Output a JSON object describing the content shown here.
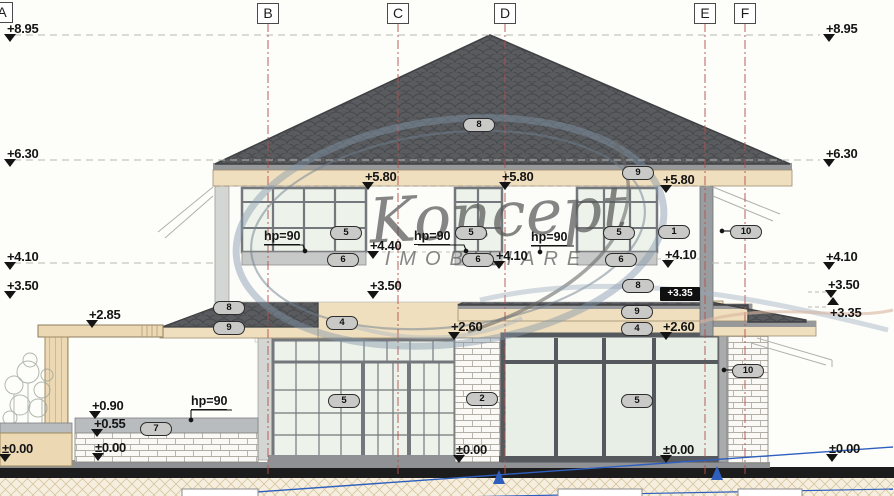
{
  "watermark": {
    "name": "Koncept",
    "subtitle": "IMOBILIARE"
  },
  "grid": {
    "letters": [
      "A",
      "B",
      "C",
      "D",
      "E",
      "F"
    ]
  },
  "hp": {
    "text": "hp=90"
  },
  "marks": [
    {
      "text": "+8.95"
    },
    {
      "text": "+6.30"
    },
    {
      "text": "+4.10"
    },
    {
      "text": "+3.50"
    },
    {
      "text": "±0.00"
    },
    {
      "text": "+8.95"
    },
    {
      "text": "+6.30"
    },
    {
      "text": "+4.10"
    },
    {
      "text": "+3.50"
    },
    {
      "text": "+3.35"
    },
    {
      "text": "±0.00"
    },
    {
      "text": "+5.80"
    },
    {
      "text": "+5.80"
    },
    {
      "text": "+5.80"
    },
    {
      "text": "+4.40"
    },
    {
      "text": "+4.10"
    },
    {
      "text": "+4.10"
    },
    {
      "text": "+3.50"
    },
    {
      "text": "+2.85"
    },
    {
      "text": "+2.60"
    },
    {
      "text": "+2.60"
    },
    {
      "text": "+0.90"
    },
    {
      "text": "+0.55"
    },
    {
      "text": "±0.00"
    },
    {
      "text": "±0.00"
    },
    {
      "text": "±0.00"
    },
    {
      "text": "+3.35"
    }
  ],
  "numbers": [
    {
      "text": "8"
    },
    {
      "text": "9"
    },
    {
      "text": "5"
    },
    {
      "text": "6"
    },
    {
      "text": "5"
    },
    {
      "text": "6"
    },
    {
      "text": "5"
    },
    {
      "text": "6"
    },
    {
      "text": "1"
    },
    {
      "text": "10"
    },
    {
      "text": "8"
    },
    {
      "text": "9"
    },
    {
      "text": "4"
    },
    {
      "text": "8"
    },
    {
      "text": "9"
    },
    {
      "text": "4"
    },
    {
      "text": "2"
    },
    {
      "text": "5"
    },
    {
      "text": "5"
    },
    {
      "text": "10"
    },
    {
      "text": "7"
    }
  ],
  "colors": {
    "roof": "#595b5f",
    "roof_edge": "#3f4144",
    "fascia": "#f0dfbe",
    "trim_gray": "#96989a",
    "pane": "#edf2ea",
    "frame": "#74787c",
    "frame_dark": "#55585c",
    "band_beige": "#f0dfbe",
    "ground_black": "#1c1c1c",
    "earth": "#f6efdf",
    "grid_red": "#b5504b",
    "annotation_blue": "#2e5fbe",
    "watermark_steel": "#8297ab"
  }
}
